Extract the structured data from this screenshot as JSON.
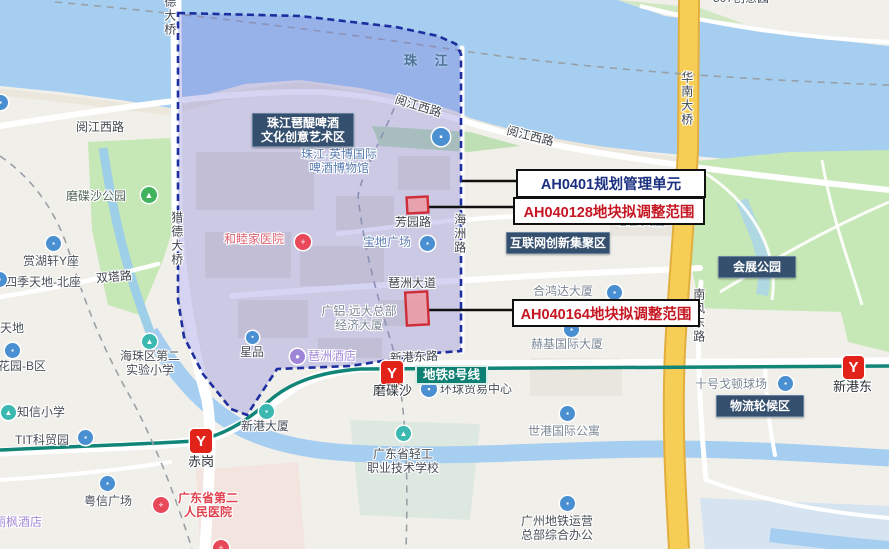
{
  "map_title": "琶洲规划单元调整示意地图",
  "colors": {
    "overlay_fill": "rgba(115,112,214,0.30)",
    "overlay_stroke": "#1d2f9e",
    "parcel_stroke": "#cf2e38",
    "parcel_fill": "rgba(242,148,156,0.75)",
    "callout_navy": "#1b2f80",
    "callout_red": "#c51622",
    "metro_line": "#108578",
    "metro_logo_red": "#e2231a",
    "region_label_bg": "#35506e",
    "water": "#a6cef0",
    "park": "#c6e7b6",
    "highway_yellow": "#f6cd55"
  },
  "callouts": [
    {
      "id": "callout-ah0401",
      "text": "AH0401规划管理单元",
      "color": "#1b2f80",
      "x": 516,
      "y": 169,
      "w": 186,
      "h": 25,
      "line": {
        "x1": 462,
        "y1": 181,
        "x2": 516,
        "y2": 181
      }
    },
    {
      "id": "callout-ah040128",
      "text": "AH040128地块拟调整范围",
      "color": "#c51622",
      "x": 513,
      "y": 197,
      "w": 188,
      "h": 24,
      "line": {
        "x1": 428,
        "y1": 207,
        "x2": 513,
        "y2": 207
      }
    },
    {
      "id": "callout-ah040164",
      "text": "AH040164地块拟调整范围",
      "color": "#c51622",
      "x": 512,
      "y": 299,
      "w": 184,
      "h": 24,
      "line": {
        "x1": 429,
        "y1": 310,
        "x2": 512,
        "y2": 310
      }
    }
  ],
  "parcels": [
    {
      "id": "parcel-ah040128",
      "x": 407,
      "y": 197,
      "w": 21,
      "h": 16
    },
    {
      "id": "parcel-ah040164",
      "x": 406,
      "y": 292,
      "w": 22,
      "h": 33
    }
  ],
  "region_labels": [
    {
      "id": "region-label-pati",
      "lines": [
        "珠江琶醍啤酒",
        "文化创意艺术区"
      ],
      "x": 252,
      "y": 113,
      "w": 100,
      "h": 32
    },
    {
      "id": "region-label-internet",
      "lines": [
        "互联网创新集聚区"
      ],
      "x": 506,
      "y": 232,
      "w": 102,
      "h": 20
    },
    {
      "id": "region-label-exhibition-park",
      "lines": [
        "会展公园"
      ],
      "x": 718,
      "y": 256,
      "w": 76,
      "h": 20
    },
    {
      "id": "region-label-logistics",
      "lines": [
        "物流轮候区"
      ],
      "x": 716,
      "y": 395,
      "w": 86,
      "h": 20
    }
  ],
  "metro": {
    "line_label": {
      "id": "metro-line8-label",
      "text": "地铁8号线",
      "x": 415,
      "y": 365
    },
    "logo_glyph": "Y",
    "stations": [
      {
        "id": "station-chigang",
        "name": "赤岗",
        "logo": {
          "x": 190,
          "y": 429,
          "s": 22
        },
        "nx": 188,
        "ny": 455
      },
      {
        "id": "station-modiesha",
        "name": "磨碟沙",
        "logo": {
          "x": 381,
          "y": 361,
          "s": 22
        },
        "nx": 373,
        "ny": 384
      },
      {
        "id": "station-xingangdong",
        "name": "新港东",
        "logo": {
          "x": 843,
          "y": 356,
          "s": 21
        },
        "nx": 833,
        "ny": 380
      }
    ]
  },
  "water_labels": [
    {
      "id": "water-zhujiang",
      "text": "珠 江",
      "x": 404,
      "y": 54
    }
  ],
  "road_labels": [
    {
      "id": "road-yuejiangxi-left",
      "text": "阅江西路",
      "x": 76,
      "y": 121,
      "rot": 0
    },
    {
      "id": "road-yuejiangxi-mid",
      "text": "阅江西路",
      "x": 394,
      "y": 100,
      "rot": 17
    },
    {
      "id": "road-yuejiangxi-right",
      "text": "阅江西路",
      "x": 506,
      "y": 130,
      "rot": 14
    },
    {
      "id": "road-shuangta",
      "text": "双塔路",
      "x": 96,
      "y": 271,
      "rot": -5
    },
    {
      "id": "road-fangyuan",
      "text": "芳园路",
      "x": 395,
      "y": 216,
      "rot": 0
    },
    {
      "id": "road-pazhou-avenue",
      "text": "琶洲大道",
      "x": 388,
      "y": 277,
      "rot": 0
    },
    {
      "id": "road-xingangdong",
      "text": "新港东路",
      "x": 390,
      "y": 351,
      "rot": -3
    },
    {
      "id": "road-haizhou",
      "text": "海洲路",
      "x": 452,
      "y": 213,
      "vertical": true
    },
    {
      "id": "bridge-huanan",
      "text": "华南大桥",
      "x": 679,
      "y": 71,
      "vertical": true
    },
    {
      "id": "road-nanfengdong",
      "text": "南风东路",
      "x": 691,
      "y": 288,
      "vertical": true
    },
    {
      "id": "bridge-liede-top",
      "text": "猎德大桥",
      "x": 162,
      "y": -19,
      "vertical": true
    },
    {
      "id": "bridge-liede",
      "text": "猎德大桥",
      "x": 169,
      "y": 211,
      "vertical": true
    }
  ],
  "poi_labels": [
    {
      "id": "poi-modiesha-park",
      "text": "磨碟沙公园",
      "x": 66,
      "y": 190,
      "style": "poi-park",
      "icon": {
        "x": 141,
        "y": 187,
        "s": 16,
        "bg": "#41b35f",
        "glyph": "▲"
      }
    },
    {
      "id": "poi-beer-museum",
      "lines": [
        "珠江-英博国际",
        "啤酒博物馆"
      ],
      "x": 298,
      "y": 148,
      "w": 82,
      "style": "poi-blue",
      "icon": {
        "x": 432,
        "y": 128,
        "s": 18,
        "bg": "#4a8fd2",
        "glyph": "▪"
      }
    },
    {
      "id": "poi-baodi-plaza",
      "text": "宝地广场",
      "x": 363,
      "y": 236,
      "style": "poi-blue",
      "icon": {
        "x": 420,
        "y": 236,
        "s": 15,
        "bg": "#4a8fd2",
        "glyph": "▪"
      }
    },
    {
      "id": "poi-hehongda",
      "text": "合鸿达大厦",
      "x": 533,
      "y": 285,
      "style": "poi-muted",
      "icon": {
        "x": 607,
        "y": 285,
        "s": 15,
        "bg": "#4a8fd2",
        "glyph": "▪"
      }
    },
    {
      "id": "poi-zongbu-tower",
      "text": "总部大厦",
      "x": 617,
      "y": 215,
      "style": "poi-muted",
      "icon": {
        "x": 637,
        "y": 189,
        "s": 14,
        "bg": "#4a8fd2",
        "glyph": "▪"
      }
    },
    {
      "id": "poi-heji-tower",
      "text": "赫基国际大厦",
      "x": 531,
      "y": 338,
      "style": "poi-muted",
      "icon": {
        "x": 564,
        "y": 322,
        "s": 15,
        "bg": "#4a8fd2",
        "glyph": "▪"
      }
    },
    {
      "id": "poi-huanqiu-trade",
      "text": "环球贸易中心",
      "x": 440,
      "y": 383,
      "style": "poi-dark",
      "icon": {
        "x": 421,
        "y": 381,
        "s": 16,
        "bg": "#4a8fd2",
        "glyph": "▪"
      }
    },
    {
      "id": "poi-shigang-apartment",
      "text": "世港国际公寓",
      "x": 528,
      "y": 425,
      "style": "poi-muted",
      "icon": {
        "x": 560,
        "y": 406,
        "s": 15,
        "bg": "#4a8fd2",
        "glyph": "▪"
      }
    },
    {
      "id": "poi-gzmetro-hq",
      "lines": [
        "广州地铁运营",
        "总部综合办公"
      ],
      "x": 512,
      "y": 515,
      "w": 90,
      "style": "poi-dark",
      "icon": {
        "x": 560,
        "y": 496,
        "s": 15,
        "bg": "#4a8fd2",
        "glyph": "▪"
      }
    },
    {
      "id": "poi-qinggong-college",
      "lines": [
        "广东省轻工",
        "职业技术学校"
      ],
      "x": 356,
      "y": 448,
      "w": 94,
      "style": "poi-dark",
      "icon": {
        "x": 396,
        "y": 426,
        "s": 15,
        "bg": "#3bb8b0",
        "glyph": "▲"
      }
    },
    {
      "id": "poi-haizhu-school",
      "lines": [
        "海珠区第二",
        "实验小学"
      ],
      "x": 112,
      "y": 350,
      "w": 76,
      "style": "poi-dark",
      "icon": {
        "x": 142,
        "y": 334,
        "s": 15,
        "bg": "#3bb8b0",
        "glyph": "▲"
      }
    },
    {
      "id": "poi-zhixin-school",
      "text": "知信小学",
      "x": 17,
      "y": 406,
      "style": "poi-dark",
      "icon": {
        "x": 1,
        "y": 405,
        "s": 15,
        "bg": "#3bb8b0",
        "glyph": "▲"
      }
    },
    {
      "id": "poi-tit-park",
      "text": "TIT科贸园",
      "x": 15,
      "y": 434,
      "style": "poi-dark",
      "icon": {
        "x": 78,
        "y": 430,
        "s": 15,
        "bg": "#4a8fd2",
        "glyph": "▪"
      }
    },
    {
      "id": "poi-xingang-tower",
      "text": "新港大厦",
      "x": 241,
      "y": 420,
      "style": "poi-dark",
      "icon": {
        "x": 259,
        "y": 404,
        "s": 15,
        "bg": "#3bb8b0",
        "glyph": "▪"
      }
    },
    {
      "id": "poi-xingpin",
      "text": "星品",
      "x": 240,
      "y": 346,
      "style": "poi-dark",
      "icon": {
        "x": 246,
        "y": 331,
        "s": 13,
        "bg": "#4a8fd2",
        "glyph": "▪"
      }
    },
    {
      "id": "poi-yuexin-plaza",
      "text": "粤信广场",
      "x": 84,
      "y": 495,
      "style": "poi-dark",
      "icon": {
        "x": 100,
        "y": 476,
        "s": 15,
        "bg": "#4a8fd2",
        "glyph": "▪"
      }
    },
    {
      "id": "poi-gordon-court",
      "text": "十号戈顿球场",
      "x": 695,
      "y": 378,
      "style": "poi-muted",
      "icon": {
        "x": 778,
        "y": 376,
        "s": 15,
        "bg": "#4a8fd2",
        "glyph": "▪"
      }
    },
    {
      "id": "poi-sijitiandi",
      "text": "四季天地-北座",
      "x": 5,
      "y": 276,
      "style": "poi-dark",
      "icon": {
        "x": -8,
        "y": 272,
        "s": 15,
        "bg": "#4a8fd2",
        "glyph": "▪"
      }
    },
    {
      "id": "poi-shanghuxuan",
      "text": "赏湖轩Y座",
      "x": 23,
      "y": 255,
      "style": "poi-dark",
      "icon": {
        "x": 46,
        "y": 236,
        "s": 15,
        "bg": "#4a8fd2",
        "glyph": "▪"
      }
    },
    {
      "id": "poi-huayuan-b",
      "text": "花园-B区",
      "x": -2,
      "y": 360,
      "style": "poi-dark",
      "icon": {
        "x": 5,
        "y": 343,
        "s": 15,
        "bg": "#4a8fd2",
        "glyph": "▪"
      }
    },
    {
      "id": "poi-tiandi-partial",
      "text": "天地",
      "x": 0,
      "y": 322,
      "style": "poi-dark"
    },
    {
      "id": "poi-507-partial",
      "text": "507创意园",
      "x": 713,
      "y": -8,
      "style": "poi-dark"
    },
    {
      "id": "poi-lifeng-hotel",
      "text": "丽枫酒店",
      "x": -6,
      "y": 516,
      "style": "poi-purple"
    },
    {
      "id": "poi-pazhou-hotel",
      "text": "琶洲酒店",
      "x": 308,
      "y": 350,
      "style": "poi-purple",
      "icon": {
        "x": 290,
        "y": 349,
        "s": 15,
        "bg": "#9e85d8",
        "glyph": "●"
      }
    },
    {
      "id": "poi-united-hospital",
      "text": "和睦家医院",
      "x": 224,
      "y": 233,
      "style": "poi-pink",
      "icon": {
        "x": 295,
        "y": 234,
        "s": 16,
        "bg": "#e8485a",
        "glyph": "+"
      }
    },
    {
      "id": "poi-gd2-hospital",
      "lines": [
        "广东省第二",
        "人民医院"
      ],
      "x": 168,
      "y": 492,
      "w": 80,
      "style": "poi-red",
      "icon": {
        "x": 153,
        "y": 497,
        "s": 16,
        "bg": "#e8485a",
        "glyph": "+"
      }
    },
    {
      "id": "poi-hospital-partial",
      "text": "",
      "x": 213,
      "y": 541,
      "style": "poi-red",
      "icon": {
        "x": 213,
        "y": 540,
        "s": 16,
        "bg": "#e8485a",
        "glyph": "+"
      }
    },
    {
      "id": "poi-guanglv-hq",
      "lines": [
        "广铝,远大总部",
        "经济大厦"
      ],
      "x": 312,
      "y": 305,
      "w": 94,
      "style": "poi-muted"
    },
    {
      "id": "poi-edge-icon",
      "text": "",
      "x": -7,
      "y": 95,
      "style": "poi-blue",
      "icon": {
        "x": -7,
        "y": 95,
        "s": 15,
        "bg": "#4a8fd2",
        "glyph": "▪"
      }
    }
  ]
}
